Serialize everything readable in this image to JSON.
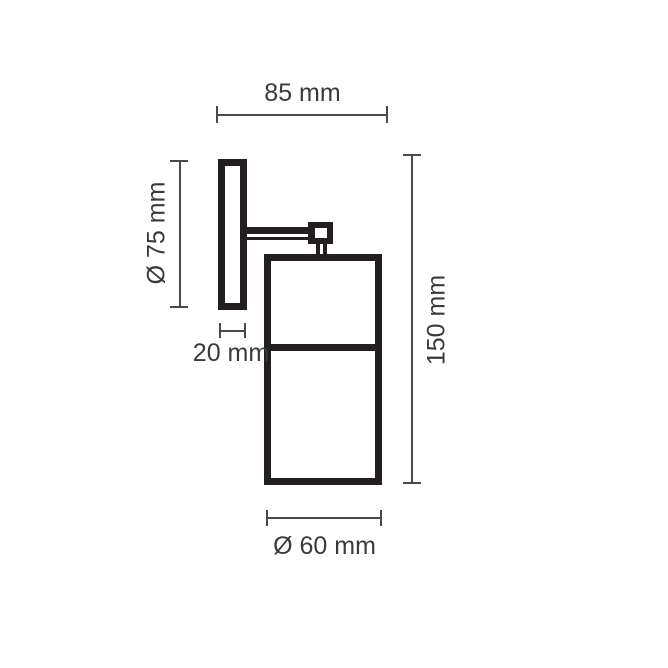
{
  "drawing": {
    "type": "technical-dimension-diagram",
    "subject": "wall-mounted cylindrical spotlight, side elevation",
    "colors": {
      "background": "#ffffff",
      "outline": "#231f20",
      "dimension_lines": "#4a4a4c",
      "labels": "#3a3a3c"
    },
    "labels": {
      "width_overall": "85 mm",
      "backplate_diameter": "Ø 75 mm",
      "backplate_depth": "20 mm",
      "height_overall": "150 mm",
      "body_diameter": "Ø 60 mm"
    }
  }
}
